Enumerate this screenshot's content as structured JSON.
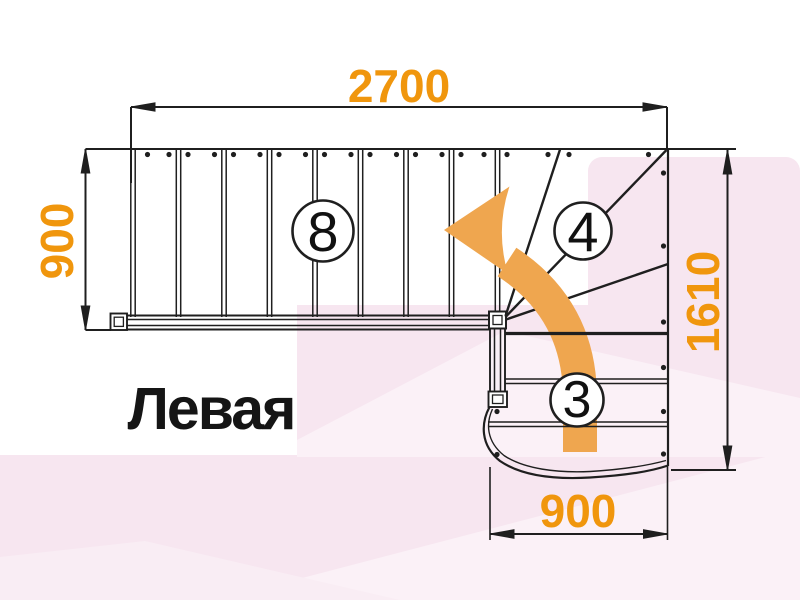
{
  "diagram": {
    "kind": "staircase-floor-plan",
    "title": "Левая"
  },
  "dimensions": {
    "top": {
      "value": "2700"
    },
    "left": {
      "value": "900"
    },
    "right": {
      "value": "1610"
    },
    "bottom": {
      "value": "900"
    }
  },
  "steps": {
    "upper_flight": {
      "count": "8"
    },
    "winder": {
      "count": "4"
    },
    "lower_flight": {
      "count": "3"
    }
  },
  "arrow": {
    "direction": "up-then-left",
    "color": "#EFA64F"
  },
  "colors": {
    "dimension_text": "#F0960D",
    "line": "#1F1F1F",
    "background_pink": "#F7E6F0",
    "background_pink_light": "#FBF1F7"
  }
}
